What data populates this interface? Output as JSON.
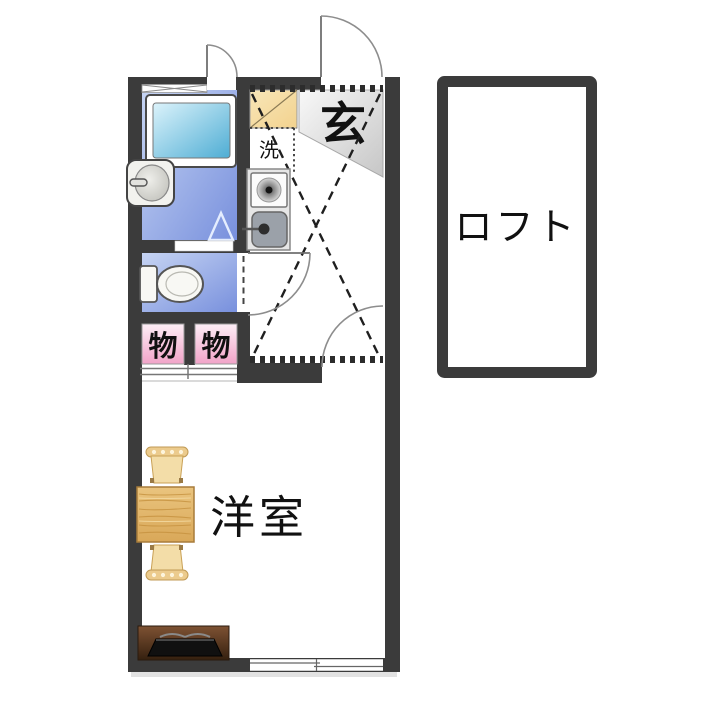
{
  "floorplan": {
    "labels": {
      "entrance": "玄",
      "laundry": "洗",
      "storage_left": "物",
      "storage_right": "物",
      "western_room": "洋室",
      "loft": "ロフト"
    },
    "colors": {
      "wall": "#3b3b3b",
      "bath_light": "#c6d4f3",
      "bath_dark": "#7890dd",
      "tub_light": "#dcf3fb",
      "tub_dark": "#4eadd4",
      "storage_pink_light": "#fdeef6",
      "storage_pink_dark": "#f1a3c8",
      "shoe_cabinet_light": "#f8e6b8",
      "shoe_cabinet_dark": "#f2d28e",
      "entrance_gray_light": "#f8f8f8",
      "entrance_gray_dark": "#c6c6c6",
      "table_wood_light": "#eac47e",
      "table_wood_dark": "#d9a859",
      "tv_stand_light": "#7e5233",
      "tv_stand_dark": "#35200f"
    }
  }
}
